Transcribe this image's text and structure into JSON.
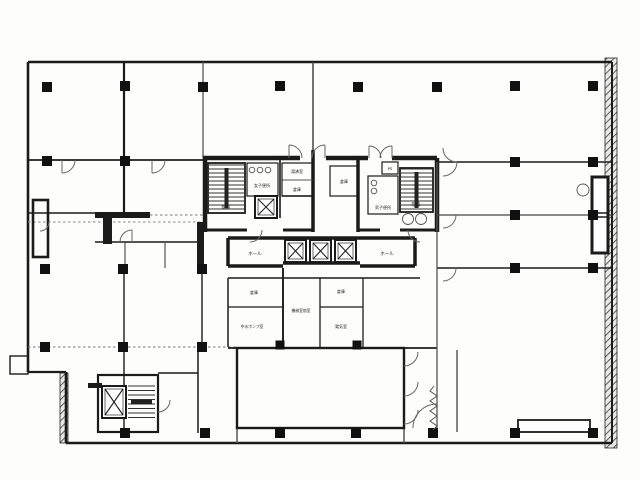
{
  "meta": {
    "canvas": {
      "w": 640,
      "h": 480
    },
    "background": "#fdfdfb",
    "ink": "#1b1b1b",
    "thin_line": "#555555",
    "arc_line": "#666666",
    "document_type": "building-floor-plan-scan"
  },
  "plan": {
    "hatches": [
      {
        "x": 605,
        "y": 58,
        "w": 12,
        "h": 390
      },
      {
        "x": 60,
        "y": 373,
        "w": 8,
        "h": 70
      }
    ],
    "walls": [
      {
        "x1": 28,
        "y1": 62,
        "x2": 612,
        "y2": 62,
        "w": 2.6
      },
      {
        "x1": 28,
        "y1": 62,
        "x2": 28,
        "y2": 372,
        "w": 2.6
      },
      {
        "x1": 28,
        "y1": 372,
        "x2": 66,
        "y2": 372,
        "w": 2.2
      },
      {
        "x1": 66,
        "y1": 372,
        "x2": 66,
        "y2": 443,
        "w": 2.6
      },
      {
        "x1": 66,
        "y1": 443,
        "x2": 612,
        "y2": 443,
        "w": 2.6
      },
      {
        "x1": 612,
        "y1": 62,
        "x2": 612,
        "y2": 443,
        "w": 2.0
      },
      {
        "x1": 124,
        "y1": 62,
        "x2": 124,
        "y2": 213,
        "w": 2.2
      },
      {
        "x1": 203,
        "y1": 62,
        "x2": 203,
        "y2": 158,
        "w": 1.3,
        "c": "#555555"
      },
      {
        "x1": 313,
        "y1": 62,
        "x2": 313,
        "y2": 150,
        "w": 1.5,
        "c": "#444444"
      },
      {
        "x1": 28,
        "y1": 160,
        "x2": 203,
        "y2": 160,
        "w": 1.8
      },
      {
        "x1": 28,
        "y1": 213,
        "x2": 98,
        "y2": 213,
        "w": 1.6
      },
      {
        "x1": 150,
        "y1": 215,
        "x2": 203,
        "y2": 215,
        "w": 1.0,
        "c": "#777777",
        "d": 1
      },
      {
        "x1": 28,
        "y1": 222,
        "x2": 203,
        "y2": 222,
        "w": 1.0,
        "c": "#888888",
        "d": 1
      },
      {
        "x1": 95,
        "y1": 242,
        "x2": 203,
        "y2": 242,
        "w": 1.6
      },
      {
        "x1": 125,
        "y1": 242,
        "x2": 125,
        "y2": 268,
        "w": 1.1,
        "c": "#444444"
      },
      {
        "x1": 165,
        "y1": 242,
        "x2": 165,
        "y2": 268,
        "w": 1.1,
        "c": "#444444"
      },
      {
        "x1": 28,
        "y1": 347,
        "x2": 237,
        "y2": 347,
        "w": 1.1,
        "c": "#777777",
        "d": 1
      },
      {
        "x1": 124,
        "y1": 268,
        "x2": 124,
        "y2": 433,
        "w": 1.4
      },
      {
        "x1": 202,
        "y1": 268,
        "x2": 202,
        "y2": 347,
        "w": 1.4
      },
      {
        "x1": 198,
        "y1": 347,
        "x2": 198,
        "y2": 433,
        "w": 1.5
      },
      {
        "x1": 158,
        "y1": 373,
        "x2": 198,
        "y2": 373,
        "w": 1.5
      },
      {
        "x1": 203,
        "y1": 158,
        "x2": 300,
        "y2": 158,
        "w": 4.5
      },
      {
        "x1": 326,
        "y1": 158,
        "x2": 368,
        "y2": 158,
        "w": 4.5
      },
      {
        "x1": 392,
        "y1": 158,
        "x2": 437,
        "y2": 158,
        "w": 4.5
      },
      {
        "x1": 205,
        "y1": 158,
        "x2": 205,
        "y2": 232,
        "w": 4.5
      },
      {
        "x1": 437,
        "y1": 158,
        "x2": 437,
        "y2": 232,
        "w": 4.5
      },
      {
        "x1": 313,
        "y1": 150,
        "x2": 313,
        "y2": 232,
        "w": 3.5
      },
      {
        "x1": 358,
        "y1": 158,
        "x2": 358,
        "y2": 232,
        "w": 3.5
      },
      {
        "x1": 205,
        "y1": 230,
        "x2": 247,
        "y2": 230,
        "w": 3.0
      },
      {
        "x1": 283,
        "y1": 230,
        "x2": 313,
        "y2": 230,
        "w": 3.0
      },
      {
        "x1": 358,
        "y1": 230,
        "x2": 380,
        "y2": 230,
        "w": 3.0
      },
      {
        "x1": 400,
        "y1": 230,
        "x2": 437,
        "y2": 230,
        "w": 3.0
      },
      {
        "x1": 280,
        "y1": 158,
        "x2": 280,
        "y2": 218,
        "w": 1.6
      },
      {
        "x1": 282,
        "y1": 180,
        "x2": 313,
        "y2": 180,
        "w": 1.1,
        "c": "#555555"
      },
      {
        "x1": 282,
        "y1": 196,
        "x2": 313,
        "y2": 196,
        "w": 1.4
      },
      {
        "x1": 228,
        "y1": 238,
        "x2": 283,
        "y2": 238,
        "w": 3.5
      },
      {
        "x1": 228,
        "y1": 238,
        "x2": 228,
        "y2": 266,
        "w": 3.5
      },
      {
        "x1": 228,
        "y1": 266,
        "x2": 283,
        "y2": 266,
        "w": 3.5
      },
      {
        "x1": 283,
        "y1": 238,
        "x2": 360,
        "y2": 238,
        "w": 3.5
      },
      {
        "x1": 283,
        "y1": 263,
        "x2": 360,
        "y2": 263,
        "w": 3.5
      },
      {
        "x1": 360,
        "y1": 238,
        "x2": 415,
        "y2": 238,
        "w": 3.5
      },
      {
        "x1": 360,
        "y1": 266,
        "x2": 415,
        "y2": 266,
        "w": 3.5
      },
      {
        "x1": 415,
        "y1": 238,
        "x2": 415,
        "y2": 266,
        "w": 3.5
      },
      {
        "x1": 228,
        "y1": 278,
        "x2": 420,
        "y2": 278,
        "w": 1.5
      },
      {
        "x1": 228,
        "y1": 278,
        "x2": 228,
        "y2": 347,
        "w": 1.5
      },
      {
        "x1": 283,
        "y1": 268,
        "x2": 283,
        "y2": 347,
        "w": 1.9
      },
      {
        "x1": 320,
        "y1": 278,
        "x2": 320,
        "y2": 347,
        "w": 1.3
      },
      {
        "x1": 363,
        "y1": 278,
        "x2": 363,
        "y2": 347,
        "w": 1.3
      },
      {
        "x1": 228,
        "y1": 307,
        "x2": 283,
        "y2": 307,
        "w": 1.3
      },
      {
        "x1": 320,
        "y1": 307,
        "x2": 363,
        "y2": 307,
        "w": 1.3
      },
      {
        "x1": 228,
        "y1": 348,
        "x2": 437,
        "y2": 348,
        "w": 1.8
      },
      {
        "x1": 437,
        "y1": 162,
        "x2": 612,
        "y2": 162,
        "w": 1.6
      },
      {
        "x1": 437,
        "y1": 215,
        "x2": 612,
        "y2": 215,
        "w": 1.3,
        "c": "#444444"
      },
      {
        "x1": 437,
        "y1": 268,
        "x2": 612,
        "y2": 268,
        "w": 1.4
      },
      {
        "x1": 437,
        "y1": 162,
        "x2": 437,
        "y2": 433,
        "w": 1.3,
        "c": "#555555"
      },
      {
        "x1": 457,
        "y1": 350,
        "x2": 457,
        "y2": 432,
        "w": 1.3,
        "c": "#444444"
      },
      {
        "x1": 518,
        "y1": 424,
        "x2": 590,
        "y2": 424,
        "w": 0.8,
        "c": "#555555"
      },
      {
        "x1": 237,
        "y1": 428,
        "x2": 237,
        "y2": 443,
        "w": 1.5,
        "c": "#555555"
      },
      {
        "x1": 404,
        "y1": 428,
        "x2": 404,
        "y2": 443,
        "w": 1.5,
        "c": "#555555"
      }
    ],
    "rects": [
      {
        "x": 237,
        "y": 348,
        "w": 167,
        "h": 80,
        "sw": 2.4
      },
      {
        "x": 98,
        "y": 375,
        "w": 60,
        "h": 57,
        "sw": 2.2
      },
      {
        "x": 208,
        "y": 163,
        "w": 37,
        "h": 50,
        "sw": 1.8
      },
      {
        "x": 247,
        "y": 163,
        "w": 31,
        "h": 33,
        "sw": 1.2
      },
      {
        "x": 282,
        "y": 163,
        "w": 31,
        "h": 33,
        "sw": 1.2
      },
      {
        "x": 330,
        "y": 166,
        "w": 28,
        "h": 30,
        "sw": 1.2
      },
      {
        "x": 382,
        "y": 162,
        "w": 16,
        "h": 12,
        "sw": 1.2
      },
      {
        "x": 368,
        "y": 176,
        "w": 30,
        "h": 38,
        "sw": 1.2
      },
      {
        "x": 400,
        "y": 168,
        "w": 33,
        "h": 44,
        "sw": 1.8
      },
      {
        "x": 592,
        "y": 177,
        "w": 16,
        "h": 76,
        "sw": 3.0,
        "f": "#ffffff"
      },
      {
        "x": 592,
        "y": 213,
        "w": 16,
        "h": 4,
        "sw": 1.5
      },
      {
        "x": 518,
        "y": 420,
        "w": 72,
        "h": 12,
        "sw": 1.8,
        "f": "#ffffff"
      },
      {
        "x": 10,
        "y": 356,
        "w": 18,
        "h": 18,
        "sw": 1.4
      },
      {
        "x": 33,
        "y": 200,
        "w": 15,
        "h": 57,
        "sw": 2.6
      }
    ],
    "bars": [
      {
        "x": 95,
        "y": 212,
        "w": 55,
        "h": 6
      },
      {
        "x": 103,
        "y": 218,
        "w": 9,
        "h": 26
      },
      {
        "x": 88,
        "y": 383,
        "w": 14,
        "h": 5
      },
      {
        "x": 197,
        "y": 222,
        "w": 7,
        "h": 48
      }
    ],
    "columns": [
      {
        "x": 47,
        "y": 87
      },
      {
        "x": 125,
        "y": 86
      },
      {
        "x": 203,
        "y": 87
      },
      {
        "x": 280,
        "y": 86
      },
      {
        "x": 358,
        "y": 87
      },
      {
        "x": 437,
        "y": 87
      },
      {
        "x": 515,
        "y": 86
      },
      {
        "x": 593,
        "y": 86
      },
      {
        "x": 47,
        "y": 161
      },
      {
        "x": 125,
        "y": 161
      },
      {
        "x": 515,
        "y": 162
      },
      {
        "x": 593,
        "y": 162
      },
      {
        "x": 515,
        "y": 215
      },
      {
        "x": 593,
        "y": 215
      },
      {
        "x": 45,
        "y": 269
      },
      {
        "x": 123,
        "y": 269
      },
      {
        "x": 202,
        "y": 269
      },
      {
        "x": 515,
        "y": 268
      },
      {
        "x": 593,
        "y": 268
      },
      {
        "x": 45,
        "y": 347
      },
      {
        "x": 123,
        "y": 347
      },
      {
        "x": 202,
        "y": 347
      },
      {
        "x": 125,
        "y": 433
      },
      {
        "x": 205,
        "y": 433
      },
      {
        "x": 280,
        "y": 433
      },
      {
        "x": 356,
        "y": 433
      },
      {
        "x": 433,
        "y": 433
      },
      {
        "x": 515,
        "y": 433
      },
      {
        "x": 593,
        "y": 433
      },
      {
        "x": 280,
        "y": 345,
        "s": 9
      },
      {
        "x": 357,
        "y": 345,
        "s": 9
      }
    ],
    "stairs": [
      {
        "x": 209,
        "y": 165,
        "w": 35,
        "h": 46,
        "step": 4,
        "rail": "v"
      },
      {
        "x": 401,
        "y": 169,
        "w": 31,
        "h": 42,
        "step": 4,
        "rail": "v"
      },
      {
        "x": 128,
        "y": 386,
        "w": 27,
        "h": 32,
        "step": 4.5,
        "rail": "h"
      }
    ],
    "xboxes": [
      {
        "x": 255,
        "y": 196,
        "w": 22,
        "h": 22
      },
      {
        "x": 285,
        "y": 240,
        "w": 21,
        "h": 22
      },
      {
        "x": 310,
        "y": 240,
        "w": 21,
        "h": 22
      },
      {
        "x": 335,
        "y": 240,
        "w": 21,
        "h": 22
      },
      {
        "x": 102,
        "y": 386,
        "w": 24,
        "h": 32
      }
    ],
    "fixtures": [
      {
        "cx": 252,
        "cy": 170,
        "r": 2.8
      },
      {
        "cx": 260,
        "cy": 170,
        "r": 2.8
      },
      {
        "cx": 268,
        "cy": 170,
        "r": 2.8
      },
      {
        "cx": 374,
        "cy": 183,
        "r": 2.8
      },
      {
        "cx": 374,
        "cy": 191,
        "r": 2.8
      },
      {
        "cx": 408,
        "cy": 219,
        "r": 5.5
      },
      {
        "cx": 421,
        "cy": 219,
        "r": 5.5
      },
      {
        "cx": 583,
        "cy": 190,
        "r": 6.0
      }
    ],
    "arcs": [
      {
        "d": "M 302 158 A 13 13 0 0 0 289 145"
      },
      {
        "d": "M 289 158 L 289 145"
      },
      {
        "d": "M 312 158 A 13 13 0 0 1 325 145"
      },
      {
        "d": "M 325 158 L 325 145"
      },
      {
        "d": "M 381 158 A 12 12 0 0 0 369 146"
      },
      {
        "d": "M 369 158 L 369 146"
      },
      {
        "d": "M 380 158 A 12 12 0 0 1 392 146"
      },
      {
        "d": "M 392 158 L 392 146"
      },
      {
        "d": "M 75 160 A 13 13 0 0 1 62 173"
      },
      {
        "d": "M 62 160 L 62 173"
      },
      {
        "d": "M 165 160 A 13 13 0 0 1 152 173"
      },
      {
        "d": "M 152 160 L 152 173"
      },
      {
        "d": "M 120 242 A 12 12 0 0 1 132 230"
      },
      {
        "d": "M 132 242 L 132 230"
      },
      {
        "d": "M 262 230 A 12 12 0 0 1 250 242"
      },
      {
        "d": "M 457 162 A 14 14 0 0 1 443 176"
      },
      {
        "d": "M 443 148 A 14 14 0 0 0 457 162"
      },
      {
        "d": "M 456 215 A 13 13 0 0 1 443 228"
      },
      {
        "d": "M 456 268 A 13 13 0 0 1 443 281"
      },
      {
        "d": "M 404 366 A 14 14 0 0 0 418 352"
      },
      {
        "d": "M 404 396 A 14 14 0 0 0 418 382"
      },
      {
        "d": "M 404 424 A 14 14 0 0 0 418 410"
      },
      {
        "d": "M 413 428 A 24 24 0 0 1 437 404"
      },
      {
        "d": "M 158 412 A 12 12 0 0 0 170 400"
      },
      {
        "d": "M 49 222 A 9 9 0 0 1 40 231"
      },
      {
        "d": "M 408 230 A 12 12 0 0 0 420 242"
      }
    ],
    "zigzags": [
      {
        "d": "M 434 386 l -4 5 l 7 5 l -7 5 l 7 5 l -7 5 l 7 5 l -7 5 l 7 5 l -4 4"
      }
    ],
    "labels": [
      {
        "t": "階段",
        "x": 226,
        "y": 209,
        "s": 4.5
      },
      {
        "t": "女子便所",
        "x": 262,
        "y": 187,
        "s": 4.0
      },
      {
        "t": "湯沸室",
        "x": 297,
        "y": 173,
        "s": 4.0
      },
      {
        "t": "倉庫",
        "x": 297,
        "y": 191,
        "s": 4.0
      },
      {
        "t": "倉庫",
        "x": 344,
        "y": 183,
        "s": 4.0
      },
      {
        "t": "男子便所",
        "x": 383,
        "y": 209,
        "s": 4.0
      },
      {
        "t": "階段",
        "x": 416,
        "y": 206,
        "s": 4.5
      },
      {
        "t": "PS",
        "x": 390,
        "y": 170,
        "s": 3.8
      },
      {
        "t": "ホール",
        "x": 255,
        "y": 255,
        "s": 4.5
      },
      {
        "t": "ホール",
        "x": 387,
        "y": 255,
        "s": 4.5
      },
      {
        "t": "倉庫",
        "x": 254,
        "y": 294,
        "s": 4.0
      },
      {
        "t": "中水ポンプ室",
        "x": 252,
        "y": 328,
        "s": 3.8
      },
      {
        "t": "機械室前室",
        "x": 301,
        "y": 312,
        "s": 3.8
      },
      {
        "t": "倉庫",
        "x": 341,
        "y": 293,
        "s": 4.0
      },
      {
        "t": "電気室",
        "x": 341,
        "y": 328,
        "s": 4.0
      }
    ]
  }
}
